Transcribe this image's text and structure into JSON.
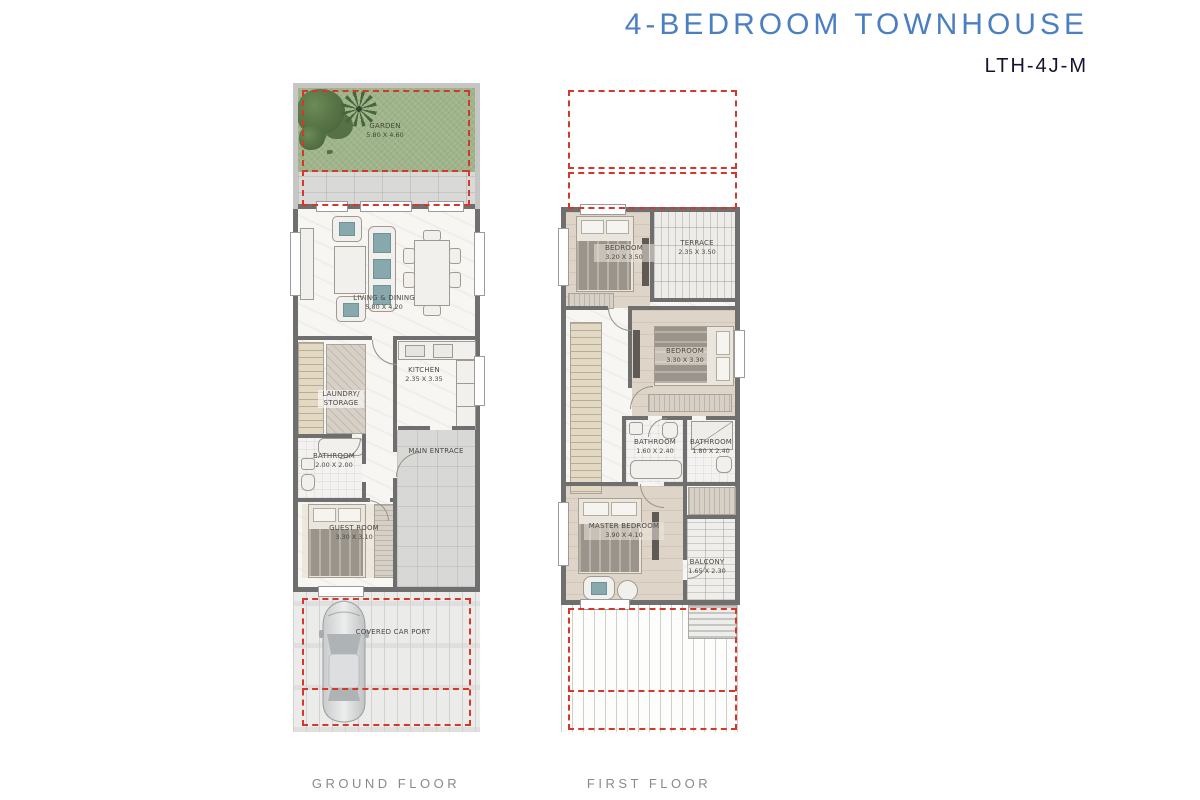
{
  "header": {
    "title": "4-BEDROOM TOWNHOUSE",
    "model_code": "LTH-4J-M"
  },
  "footer": {
    "ground_floor_label": "GROUND FLOOR",
    "first_floor_label": "FIRST FLOOR"
  },
  "colors": {
    "title_blue": "#4c7fc0",
    "plan_red": "#d4372c",
    "wall_gray": "#6f6f6f",
    "garden_green": "#9fb48a"
  },
  "ground_floor": {
    "garden": {
      "name": "GARDEN",
      "dims": "5.80 X 4.60"
    },
    "living_dining": {
      "name": "LIVING & DINING",
      "dims": "5.80 X 4.20"
    },
    "kitchen": {
      "name": "KITCHEN",
      "dims": "2.35 X 3.35"
    },
    "laundry_storage": {
      "name": "LAUNDRY/ STORAGE",
      "dims": ""
    },
    "bathroom": {
      "name": "BATHROOM",
      "dims": "2.00 X 2.00"
    },
    "main_entrance": {
      "name": "MAIN ENTRACE",
      "dims": ""
    },
    "guest_room": {
      "name": "GUEST ROOM",
      "dims": "3.30 X 3.10"
    },
    "car_port": {
      "name": "COVERED CAR PORT",
      "dims": ""
    }
  },
  "first_floor": {
    "bedroom_1": {
      "name": "BEDROOM",
      "dims": "3.20 X 3.50"
    },
    "terrace": {
      "name": "TERRACE",
      "dims": "2.35 X 3.50"
    },
    "bedroom_2": {
      "name": "BEDROOM",
      "dims": "3.30 X 3.30"
    },
    "bathroom_1": {
      "name": "BATHROOM",
      "dims": "1.60 X 2.40"
    },
    "bathroom_2": {
      "name": "BATHROOM",
      "dims": "1.80 X 2.40"
    },
    "master_bedroom": {
      "name": "MASTER BEDROOM",
      "dims": "3.90 X 4.10"
    },
    "balcony": {
      "name": "BALCONY",
      "dims": "1.65 X 2.30"
    }
  }
}
